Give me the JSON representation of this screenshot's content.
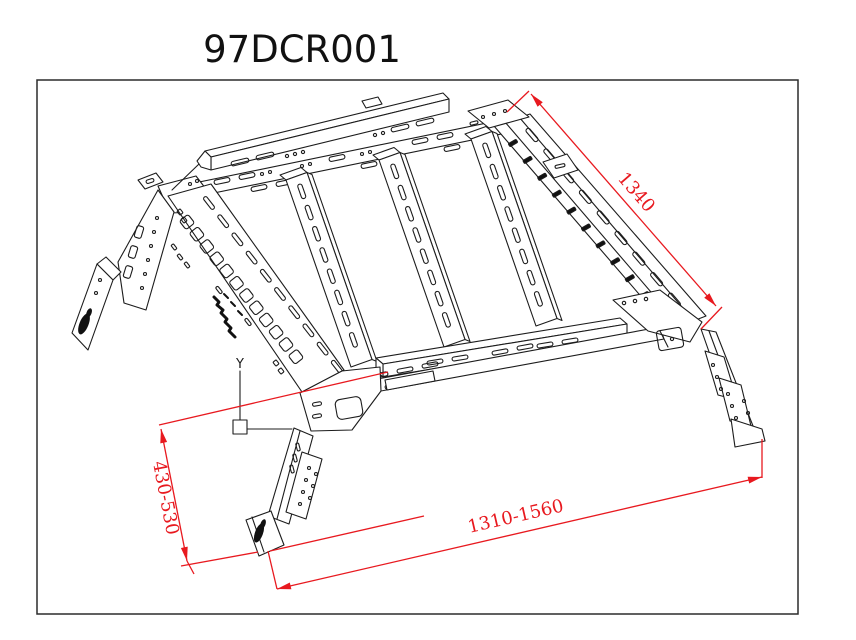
{
  "page": {
    "background": "#ffffff"
  },
  "title": "97DCR001",
  "drawing": {
    "frame_color": "#2b2b2b",
    "line_color": "#1c1c1c",
    "dimension_color": "#e8191f",
    "datum_label": "Y",
    "dimensions": [
      {
        "id": "slant-length",
        "label": "1340"
      },
      {
        "id": "leg-height-range",
        "label": "430-530"
      },
      {
        "id": "bed-length-range",
        "label": "1310-1560"
      }
    ]
  }
}
